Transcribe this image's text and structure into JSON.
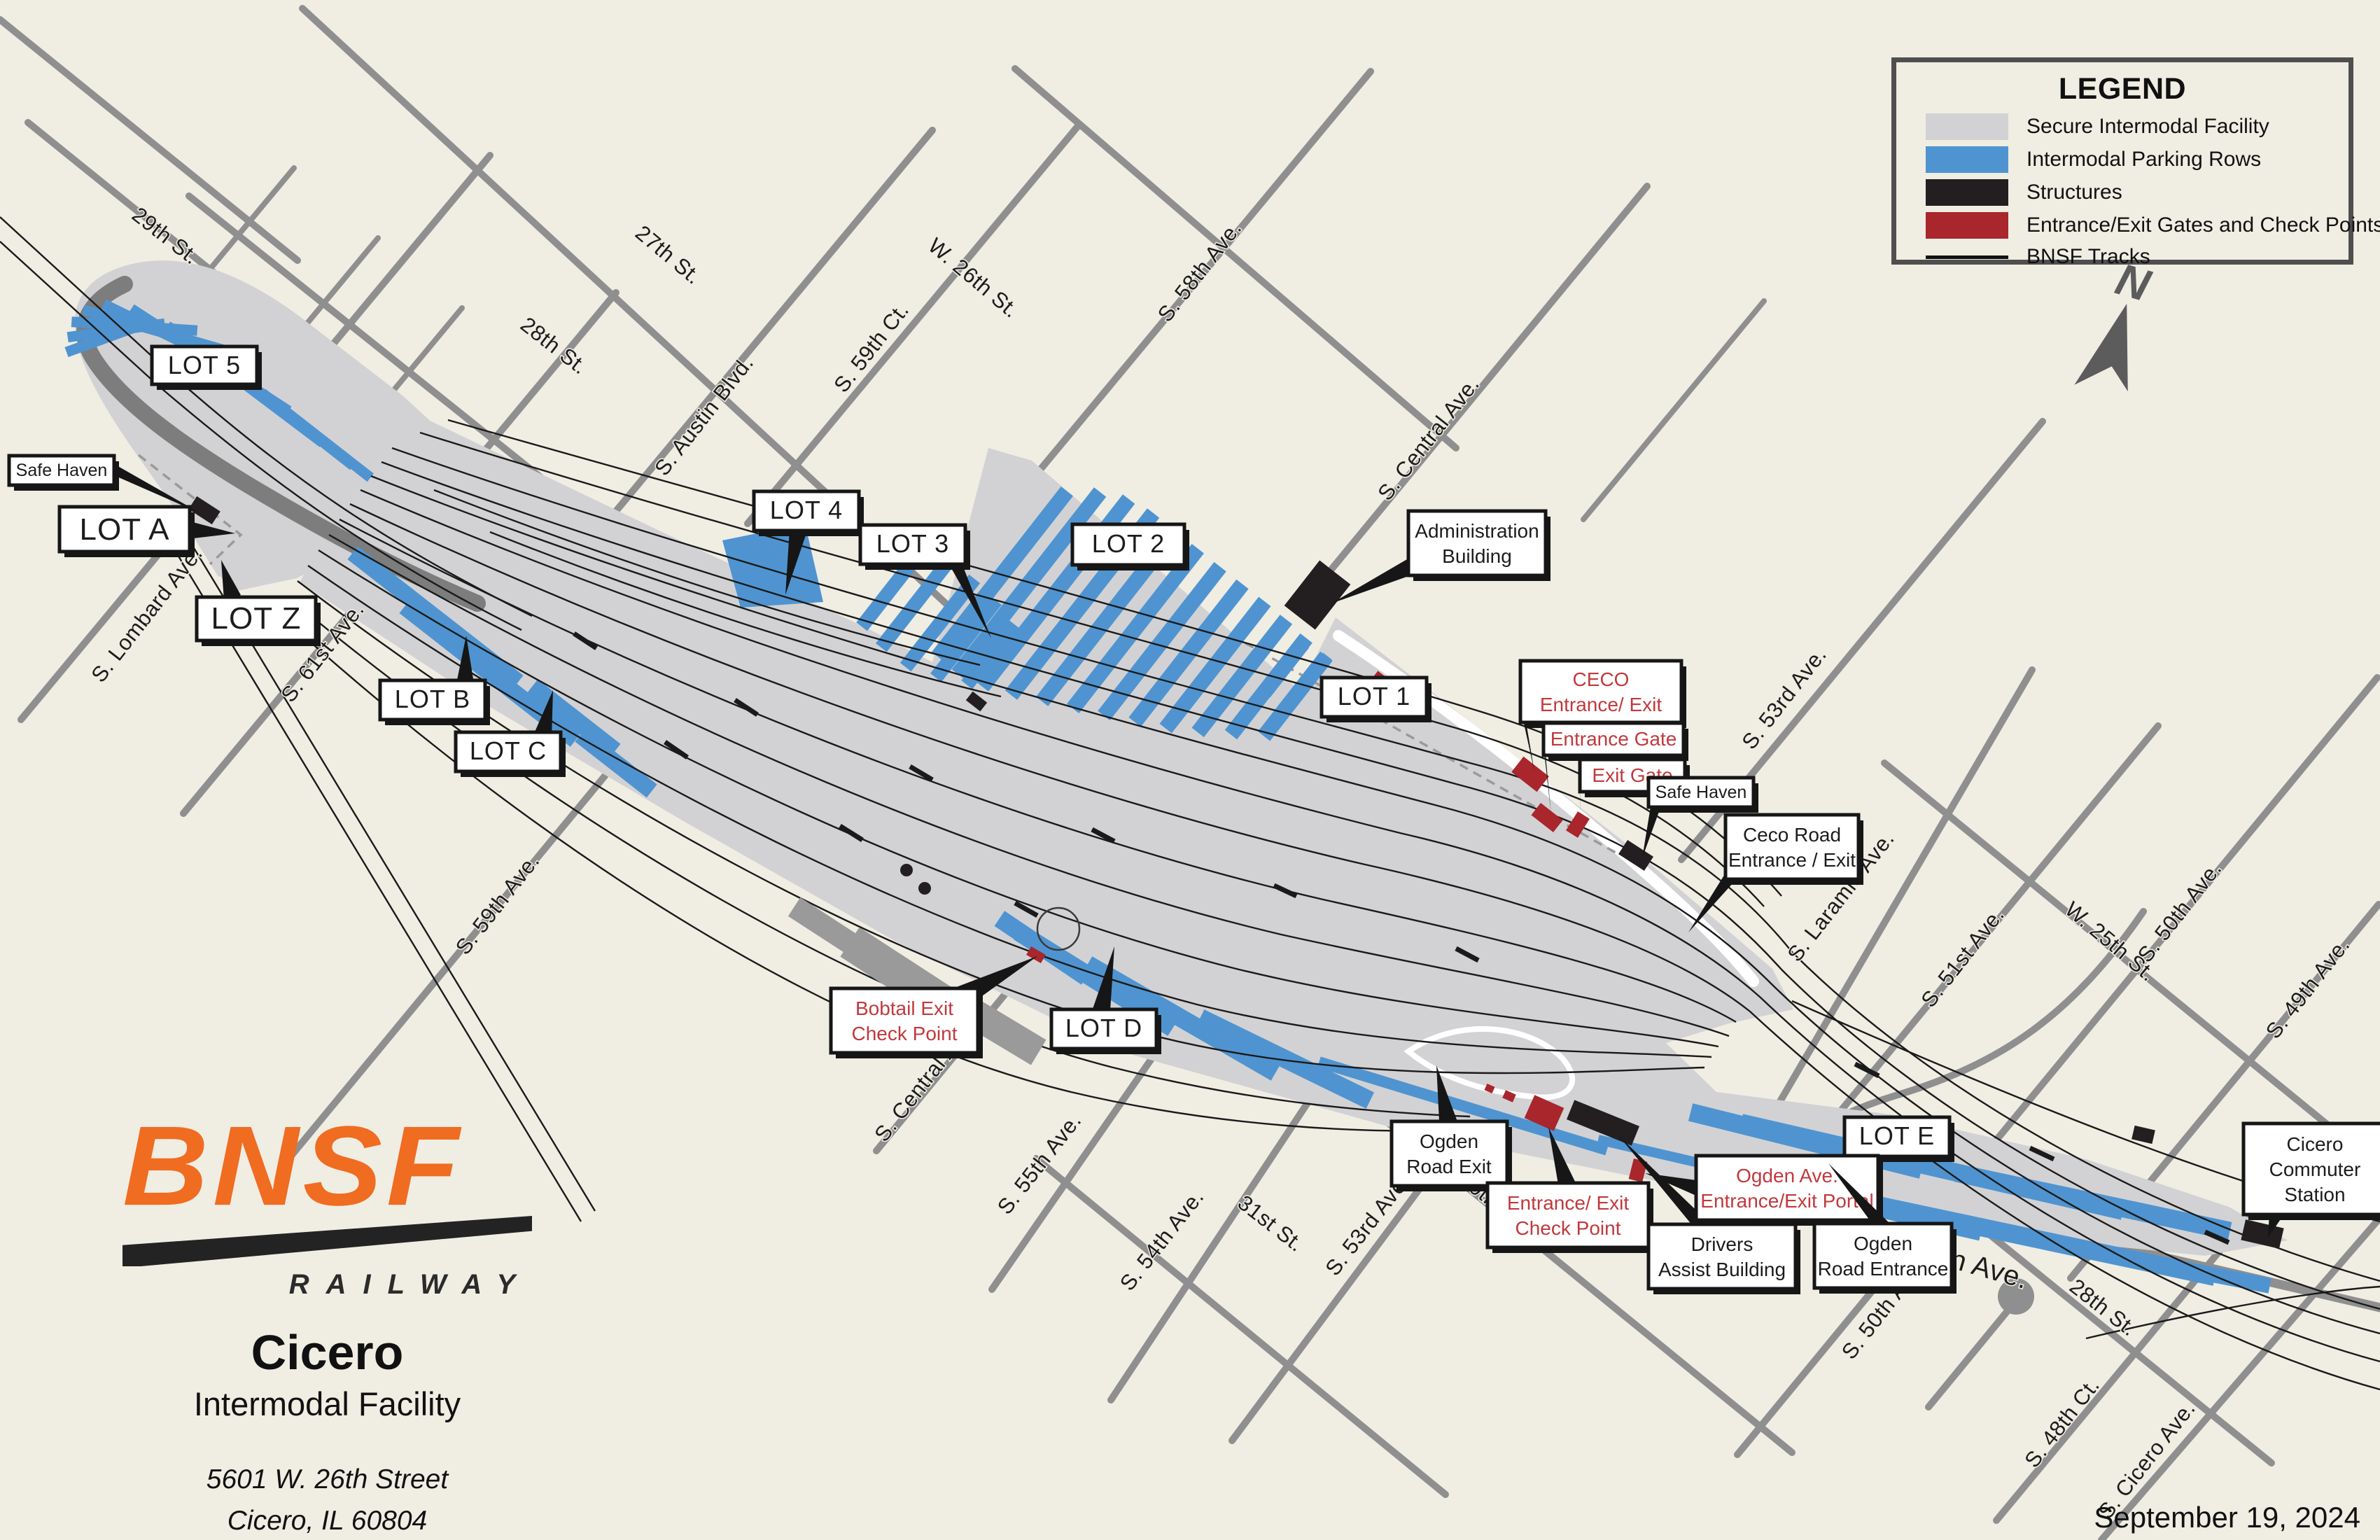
{
  "title": "BNSF Cicero Intermodal Facility Map",
  "colors": {
    "background": "#f0ede3",
    "street_gray": "#8f8f8f",
    "secure_facility_gray": "#d2d2d4",
    "parking_blue": "#4f94d0",
    "structure_black": "#231f20",
    "gate_red": "#a8262c",
    "red_label_text": "#c0393d",
    "track_black": "#1a1a1a",
    "bnsf_orange": "#f06c21"
  },
  "legend": {
    "title": "LEGEND",
    "items": [
      {
        "swatch": "secure-facility-swatch",
        "label": "Secure Intermodal Facility"
      },
      {
        "swatch": "parking-rows-swatch",
        "label": "Intermodal Parking Rows"
      },
      {
        "swatch": "structures-swatch",
        "label": "Structures"
      },
      {
        "swatch": "gates-checkpoints-swatch",
        "label": "Entrance/Exit Gates and Check Points"
      },
      {
        "swatch": "tracks-line-swatch",
        "label": "BNSF Tracks"
      }
    ]
  },
  "compass": {
    "label": "N"
  },
  "brand": {
    "logo": "BNSF",
    "railway": "RAILWAY",
    "city": "Cicero",
    "facility": "Intermodal Facility",
    "address_line1": "5601 W. 26th Street",
    "address_line2": "Cicero, IL 60804"
  },
  "footer": {
    "date": "September 19, 2024"
  },
  "streets": [
    {
      "label": "29th St."
    },
    {
      "label": "28th St."
    },
    {
      "label": "27th St."
    },
    {
      "label": "W. 26th St."
    },
    {
      "label": "S. Austin Blvd."
    },
    {
      "label": "S. 59th Ct."
    },
    {
      "label": "S. 58th Ave."
    },
    {
      "label": "S. Central Ave."
    },
    {
      "label": "S. 53rd Ave."
    },
    {
      "label": "S. Laramie Ave."
    },
    {
      "label": "S. 51st Ave."
    },
    {
      "label": "W. 25th St."
    },
    {
      "label": "S. 50th Ave."
    },
    {
      "label": "S. 49th Ave."
    },
    {
      "label": "S. Lombard Ave."
    },
    {
      "label": "S. 61st Ave."
    },
    {
      "label": "S. 59th Ave."
    },
    {
      "label": "S. Central Ave."
    },
    {
      "label": "S. 55th Ave."
    },
    {
      "label": "S. 54th Ave."
    },
    {
      "label": "31st St."
    },
    {
      "label": "S. 53rd Ave."
    },
    {
      "label": "30th St."
    },
    {
      "label": "Ogden Ave."
    },
    {
      "label": "S. 50th Ave."
    },
    {
      "label": "28th St."
    },
    {
      "label": "S. 48th Ct."
    },
    {
      "label": "S. Cicero Ave."
    }
  ],
  "callouts": {
    "lot5": {
      "label": "LOT 5"
    },
    "lot4": {
      "label": "LOT 4"
    },
    "lot3": {
      "label": "LOT 3"
    },
    "lot2": {
      "label": "LOT 2"
    },
    "lot1": {
      "label": "LOT 1"
    },
    "lotA": {
      "label": "LOT A"
    },
    "lotZ": {
      "label": "LOT Z"
    },
    "lotB": {
      "label": "LOT B"
    },
    "lotC": {
      "label": "LOT C"
    },
    "lotD": {
      "label": "LOT D"
    },
    "lotE": {
      "label": "LOT E"
    },
    "safe_haven_west": {
      "label": "Safe Haven"
    },
    "safe_haven_east": {
      "label": "Safe Haven"
    },
    "admin": {
      "lines": [
        "Administration",
        "Building"
      ]
    },
    "ceco_entrance": {
      "lines": [
        "CECO",
        "Entrance/ Exit"
      ]
    },
    "entrance_gate": {
      "label": "Entrance Gate"
    },
    "exit_gate": {
      "label": "Exit Gate"
    },
    "ceco_road": {
      "lines": [
        "Ceco Road",
        "Entrance / Exit"
      ]
    },
    "bobtail": {
      "lines": [
        "Bobtail Exit",
        "Check Point"
      ]
    },
    "ogden_road_exit": {
      "lines": [
        "Ogden",
        "Road Exit"
      ]
    },
    "entrance_exit_check_point": {
      "lines": [
        "Entrance/ Exit",
        "Check Point"
      ]
    },
    "drivers_assist": {
      "lines": [
        "Drivers",
        "Assist Building"
      ]
    },
    "ogden_portal": {
      "lines": [
        "Ogden Ave.",
        "Entrance/Exit Portal"
      ]
    },
    "ogden_road_entrance": {
      "lines": [
        "Ogden",
        "Road Entrance"
      ]
    },
    "cicero_station": {
      "lines": [
        "Cicero",
        "Commuter",
        "Station"
      ]
    }
  }
}
